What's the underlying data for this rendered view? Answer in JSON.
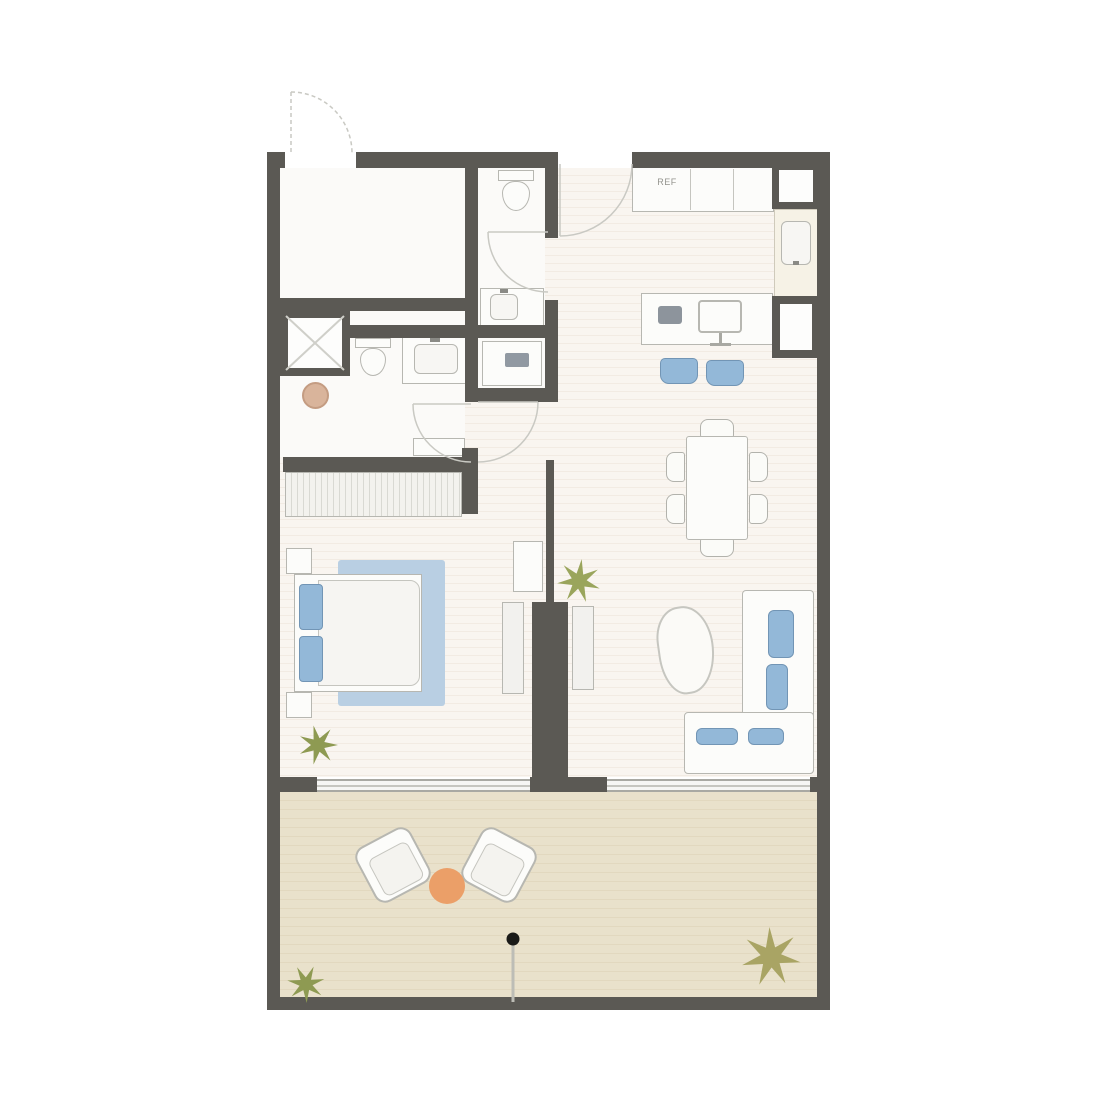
{
  "labels": {
    "refrigerator": "REF"
  },
  "colors": {
    "wall": "#5b5954",
    "interior_floor": "#f8f4ee",
    "floor_stripe": "#f2ebe3",
    "terrace_floor": "#e9e1cb",
    "terrace_stripe": "#e2d8bf",
    "window": "#f6f6f4",
    "accent_blue": "#93b8d8",
    "accent_blue_light": "#b9cfe3",
    "furniture_outline": "#b7b7b1",
    "door_arc": "#c9c9c3",
    "plant_green": "#8e9a52",
    "plant_olive": "#a9a464",
    "side_table_orange": "#eb9f68",
    "stool_tan": "#d9b49b",
    "parasol_dot": "#1a1a18"
  },
  "furniture_icons": [
    "entry-door-swing",
    "main-door-swing",
    "wc-door-swing",
    "bathroom-door-swing",
    "corridor-door-swing",
    "wc-toilet",
    "bathroom-toilet",
    "shower-x",
    "vanity-sink",
    "wc-sink",
    "washing-machine",
    "stool",
    "kitchen-counter",
    "refrigerator",
    "kitchen-sink",
    "service-shaft",
    "desk",
    "monitor",
    "laptop",
    "desk-chair",
    "dining-table",
    "dining-chair",
    "corner-sofa",
    "sofa-cushion",
    "coffee-table",
    "tv-console",
    "cabinet",
    "plant",
    "double-bed",
    "pillow",
    "area-rug",
    "nightstand",
    "wardrobe",
    "sliding-window",
    "lounge-chair",
    "round-side-table",
    "parasol-pole"
  ]
}
